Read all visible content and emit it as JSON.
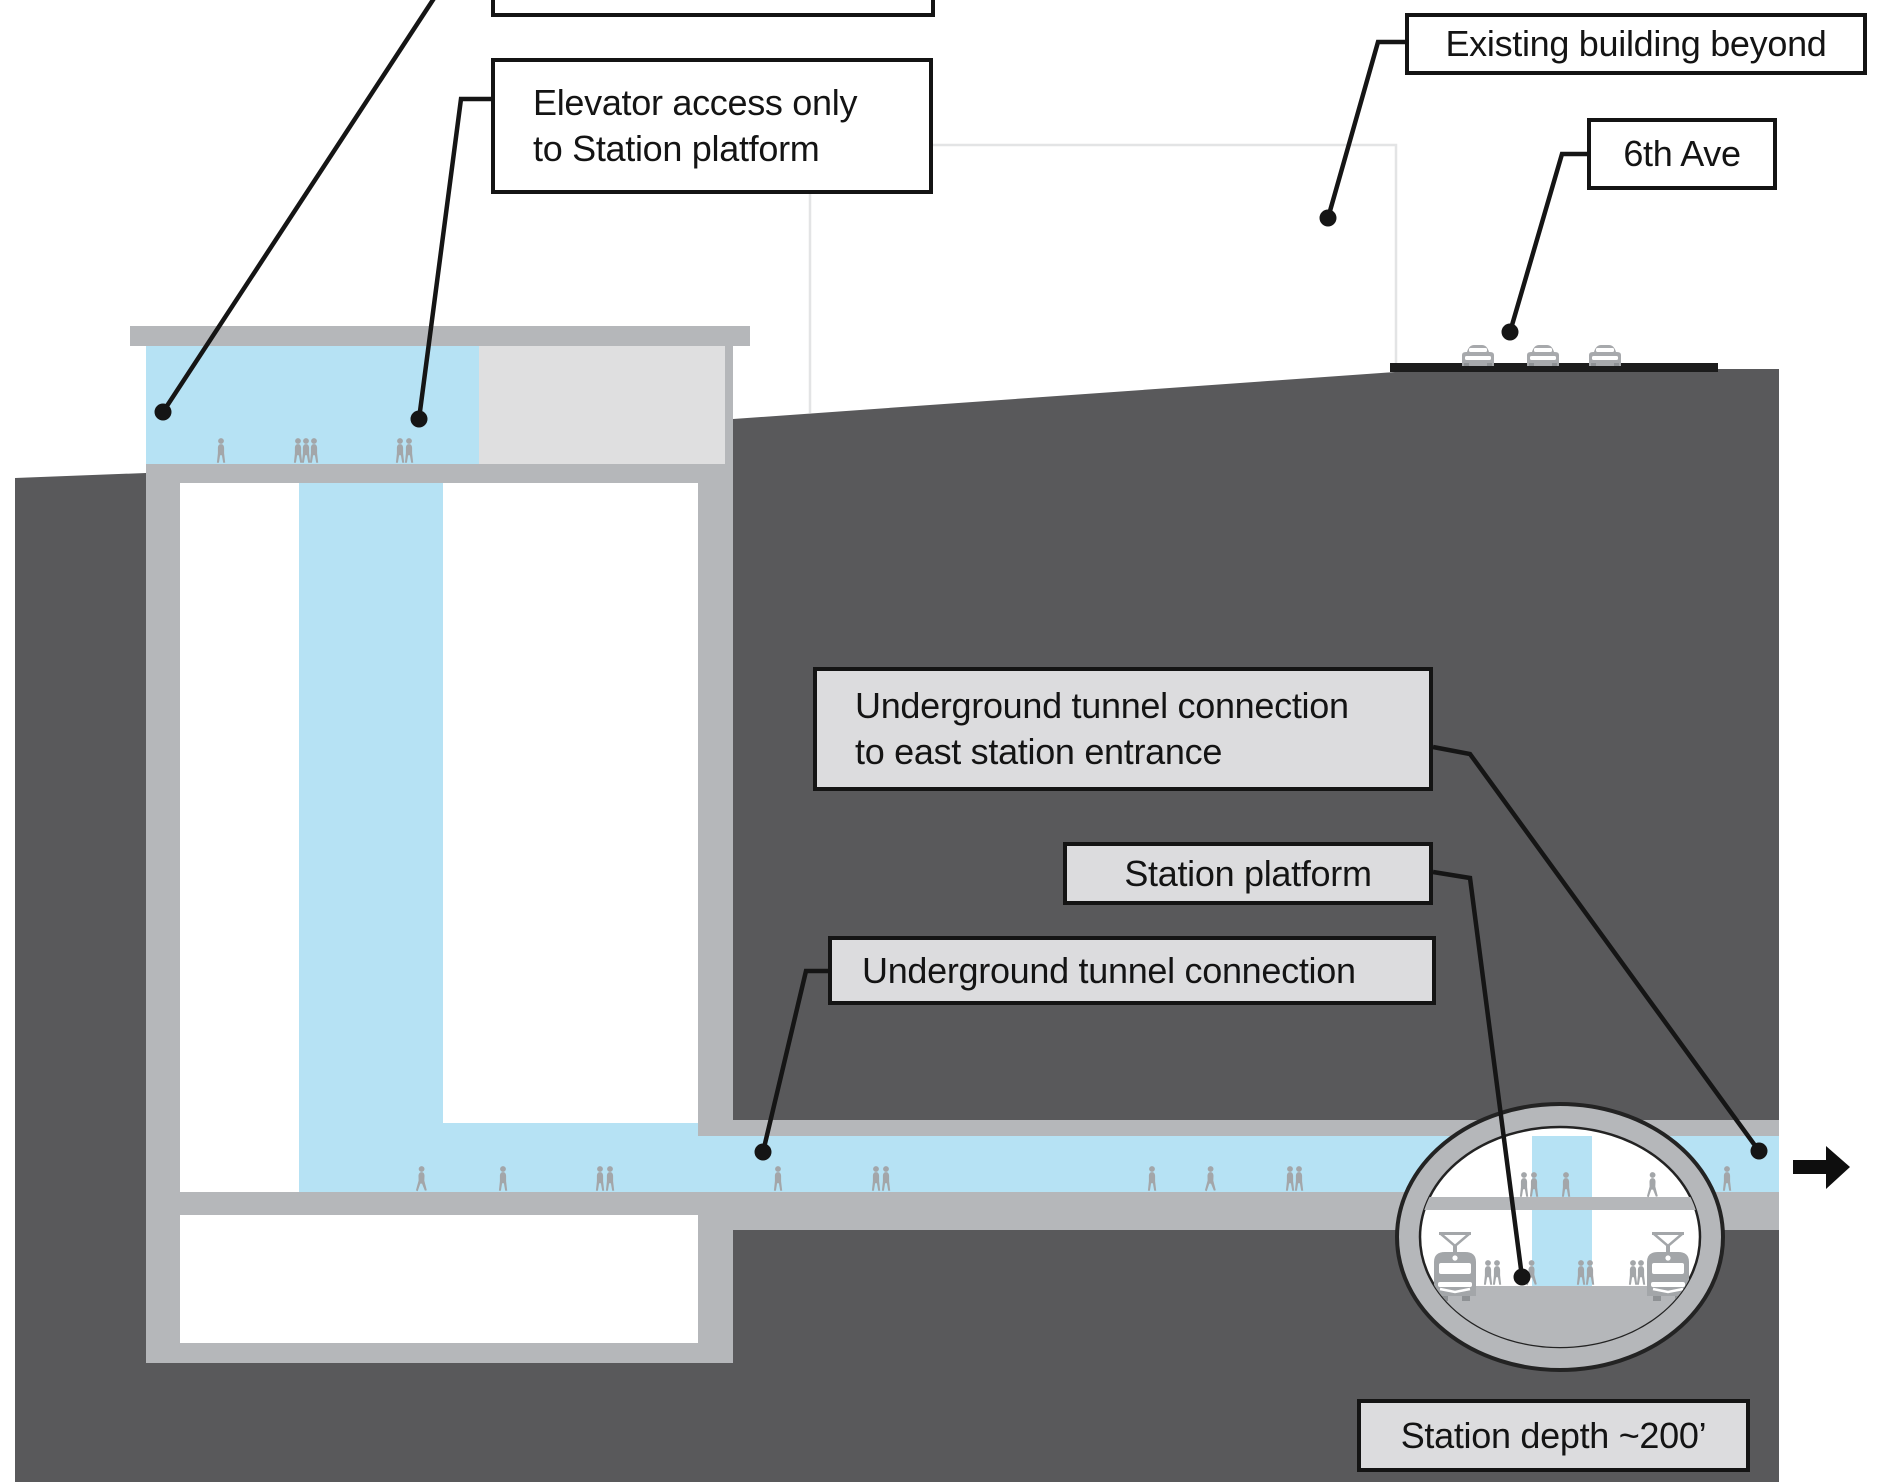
{
  "labels": {
    "top_cutoff": "",
    "elevator_line1": "Elevator access only",
    "elevator_line2": "to Station platform",
    "existing_building": "Existing building beyond",
    "sixth_ave": "6th Ave",
    "tunnel_east_line1": "Underground tunnel connection",
    "tunnel_east_line2": "to east station entrance",
    "station_platform": "Station platform",
    "tunnel": "Underground tunnel connection",
    "station_depth": "Station depth ~200’"
  },
  "colors": {
    "ground_dark": "#59595b",
    "structure_gray": "#b5b7ba",
    "room_light_gray": "#dfdfe0",
    "circulation_blue": "#b6e2f4",
    "callout_gray_fill": "#dcdcde",
    "callout_border": "#141414",
    "leader_line": "#151515",
    "people_gray": "#a3a6a9",
    "road_black": "#1c1c1c",
    "faint_outline": "#e3e4e5"
  },
  "icons": {
    "arrow": "arrow-right-icon",
    "car": "car-icon",
    "train": "train-icon",
    "person": "person-icon"
  }
}
